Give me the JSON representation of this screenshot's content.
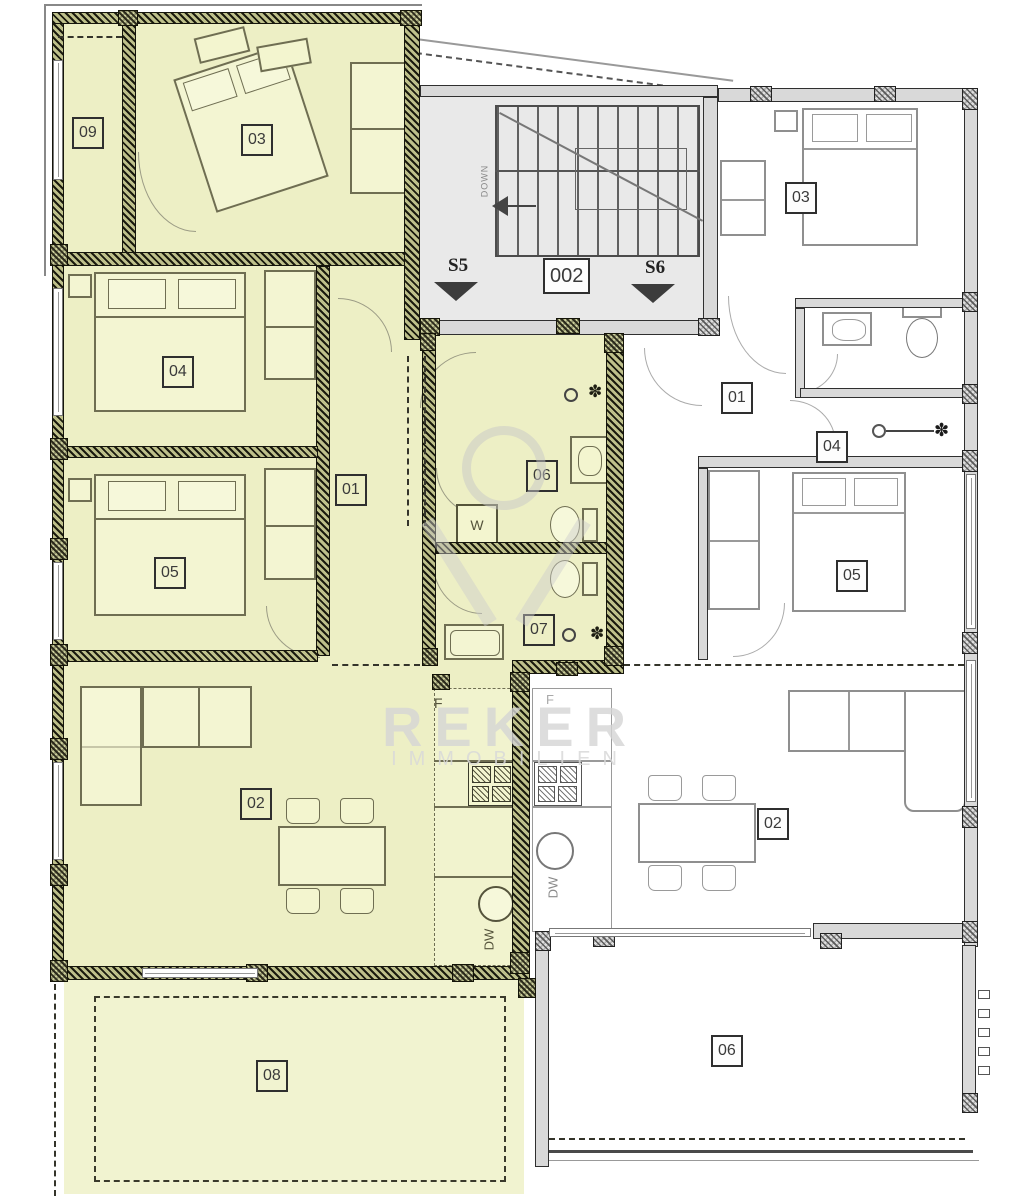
{
  "plan": {
    "type": "floor-plan",
    "watermark": {
      "brand": "REKER",
      "subtitle": "IMMOBILIEN"
    },
    "stairwell": {
      "label_left_stair": "S5",
      "label_right_stair": "S6",
      "unit_label": "002",
      "down_label": "DOWN"
    },
    "left_apartment": {
      "highlighted": true,
      "room_labels": {
        "loggia": "09",
        "bedroom_a": "03",
        "bedroom_b": "04",
        "bedroom_c": "05",
        "hall": "01",
        "bathroom_a": "06",
        "bathroom_b": "07",
        "living": "02",
        "terrace": "08"
      },
      "fixture_labels": {
        "washing_machine": "W",
        "fridge": "F",
        "dishwasher": "DW"
      }
    },
    "right_apartment": {
      "highlighted": false,
      "room_labels": {
        "bedroom_a": "03",
        "hall": "01",
        "bathroom": "04",
        "bedroom_b": "05",
        "living": "02",
        "terrace": "06"
      },
      "fixture_labels": {
        "fridge": "F",
        "dishwasher": "DW"
      }
    },
    "colors": {
      "highlight_fill": "#edefc5",
      "terrace_fill": "#f1f3d0",
      "stairwell_fill": "#e9e9e9",
      "wall_gray": "#d9d9d9",
      "watermark_gray": "#d9d9d9"
    }
  }
}
